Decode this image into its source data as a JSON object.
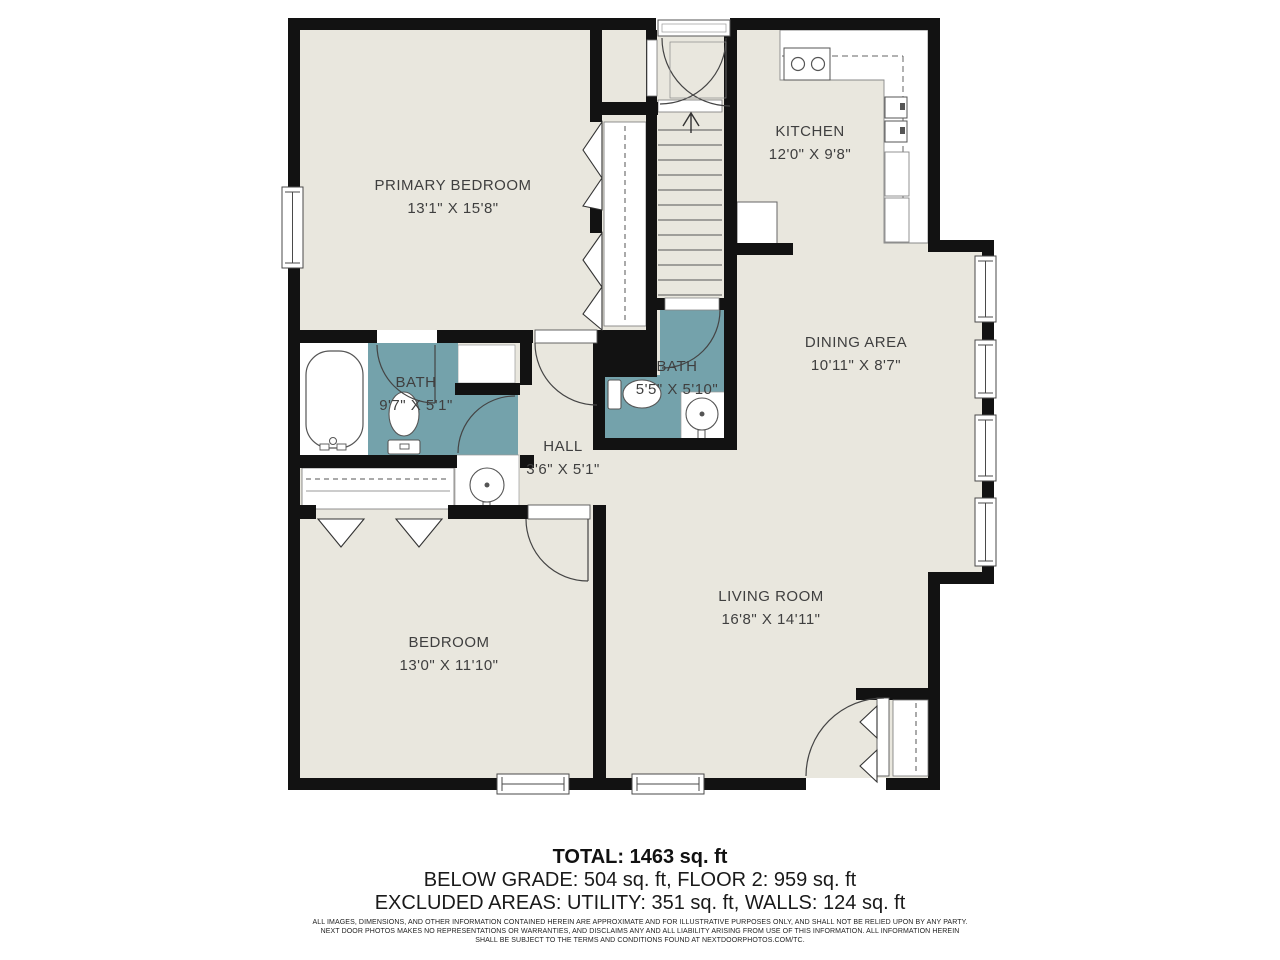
{
  "plan": {
    "rooms": [
      {
        "name": "PRIMARY BEDROOM",
        "dims": "13'1\" X 15'8\""
      },
      {
        "name": "KITCHEN",
        "dims": "12'0\" X 9'8\""
      },
      {
        "name": "DINING AREA",
        "dims": "10'11\" X 8'7\""
      },
      {
        "name": "BATH",
        "dims": "9'7\" X 5'1\""
      },
      {
        "name": "BATH",
        "dims": "5'5\" X 5'10\""
      },
      {
        "name": "HALL",
        "dims": "3'6\" X 5'1\""
      },
      {
        "name": "BEDROOM",
        "dims": "13'0\" X 11'10\""
      },
      {
        "name": "LIVING ROOM",
        "dims": "16'8\" X 14'11\""
      }
    ],
    "colors": {
      "floor": "#e9e7de",
      "bath": "#74a2ab",
      "wall": "#121212",
      "fixture_line": "#555555",
      "label_text": "#3f3f3f"
    }
  },
  "summary": {
    "total": "TOTAL: 1463 sq. ft",
    "line2": "BELOW GRADE: 504 sq. ft, FLOOR 2: 959 sq. ft",
    "line3": "EXCLUDED AREAS: UTILITY: 351 sq. ft, WALLS: 124 sq. ft"
  },
  "disclaimer": {
    "line1": "ALL IMAGES, DIMENSIONS, AND OTHER INFORMATION CONTAINED HEREIN ARE APPROXIMATE AND FOR ILLUSTRATIVE PURPOSES ONLY, AND SHALL NOT BE RELIED UPON BY ANY PARTY.",
    "line2": "NEXT DOOR PHOTOS MAKES NO REPRESENTATIONS OR WARRANTIES, AND DISCLAIMS ANY AND ALL LIABILITY ARISING FROM USE OF THIS INFORMATION. ALL INFORMATION HEREIN",
    "line3": "SHALL BE SUBJECT TO THE TERMS AND CONDITIONS FOUND AT NEXTDOORPHOTOS.COM/TC."
  }
}
